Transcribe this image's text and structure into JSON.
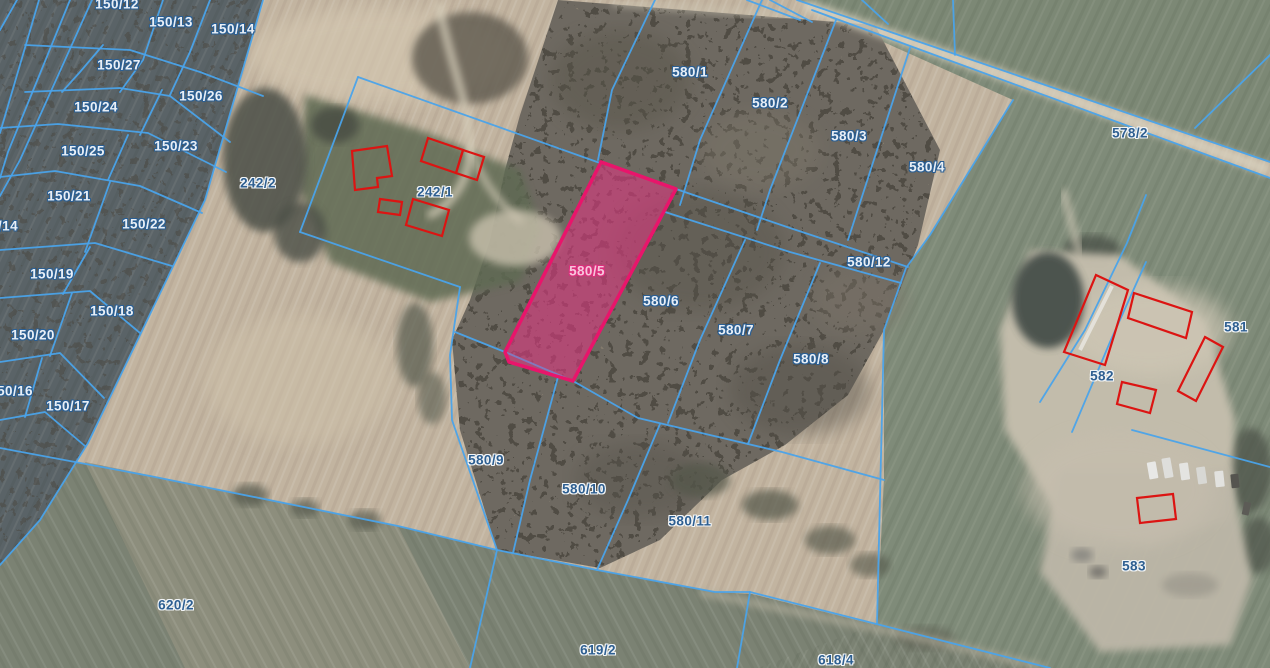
{
  "map": {
    "type": "cadastral-aerial-map",
    "colors": {
      "parcel_line": "#4aa3ea",
      "highlight_stroke": "#e8156b",
      "highlight_fill": "rgba(222,55,128,0.36)",
      "building_stroke": "#dc1412",
      "label_light": "#e9eff6",
      "label_light_outline": "#2b5f93",
      "label_dark": "#2e5f91",
      "label_pink": "#f6c6db",
      "label_pink_outline": "#dd2f7d"
    },
    "highlighted_parcel": {
      "id": "580/5"
    },
    "parcels": [
      {
        "id": "150/12",
        "x": 117,
        "y": 4,
        "style": "light"
      },
      {
        "id": "150/13",
        "x": 171,
        "y": 22,
        "style": "light"
      },
      {
        "id": "150/14",
        "x": 233,
        "y": 29,
        "style": "light"
      },
      {
        "id": "150/27",
        "x": 119,
        "y": 65,
        "style": "light"
      },
      {
        "id": "150/26",
        "x": 201,
        "y": 96,
        "style": "light"
      },
      {
        "id": "150/24",
        "x": 96,
        "y": 107,
        "style": "light"
      },
      {
        "id": "150/25",
        "x": 83,
        "y": 151,
        "style": "light"
      },
      {
        "id": "150/23",
        "x": 176,
        "y": 146,
        "style": "light"
      },
      {
        "id": "150/21",
        "x": 69,
        "y": 196,
        "style": "light"
      },
      {
        "id": "150/22",
        "x": 144,
        "y": 224,
        "style": "light"
      },
      {
        "id": "/14",
        "x": 8,
        "y": 226,
        "style": "light"
      },
      {
        "id": "150/19",
        "x": 52,
        "y": 274,
        "style": "light"
      },
      {
        "id": "150/18",
        "x": 112,
        "y": 311,
        "style": "light"
      },
      {
        "id": "150/20",
        "x": 33,
        "y": 335,
        "style": "light"
      },
      {
        "id": "50/16",
        "x": 15,
        "y": 391,
        "style": "light"
      },
      {
        "id": "150/17",
        "x": 68,
        "y": 406,
        "style": "light"
      },
      {
        "id": "242/2",
        "x": 258,
        "y": 183,
        "style": "dark"
      },
      {
        "id": "242/1",
        "x": 435,
        "y": 192,
        "style": "dark"
      },
      {
        "id": "580/1",
        "x": 690,
        "y": 72,
        "style": "light"
      },
      {
        "id": "580/2",
        "x": 770,
        "y": 103,
        "style": "light"
      },
      {
        "id": "580/3",
        "x": 849,
        "y": 136,
        "style": "light"
      },
      {
        "id": "580/4",
        "x": 927,
        "y": 167,
        "style": "light"
      },
      {
        "id": "578/2",
        "x": 1130,
        "y": 133,
        "style": "dark"
      },
      {
        "id": "580/12",
        "x": 869,
        "y": 262,
        "style": "light"
      },
      {
        "id": "580/5",
        "x": 587,
        "y": 271,
        "style": "pink"
      },
      {
        "id": "580/6",
        "x": 661,
        "y": 301,
        "style": "light"
      },
      {
        "id": "580/7",
        "x": 736,
        "y": 330,
        "style": "light"
      },
      {
        "id": "580/8",
        "x": 811,
        "y": 359,
        "style": "light"
      },
      {
        "id": "581",
        "x": 1236,
        "y": 327,
        "style": "dark"
      },
      {
        "id": "582",
        "x": 1102,
        "y": 376,
        "style": "dark"
      },
      {
        "id": "583",
        "x": 1134,
        "y": 566,
        "style": "dark"
      },
      {
        "id": "580/9",
        "x": 486,
        "y": 460,
        "style": "dark"
      },
      {
        "id": "580/10",
        "x": 584,
        "y": 489,
        "style": "dark"
      },
      {
        "id": "580/11",
        "x": 690,
        "y": 521,
        "style": "dark"
      },
      {
        "id": "620/2",
        "x": 176,
        "y": 605,
        "style": "dark"
      },
      {
        "id": "619/2",
        "x": 598,
        "y": 650,
        "style": "dark"
      },
      {
        "id": "618/4",
        "x": 836,
        "y": 660,
        "style": "dark"
      }
    ]
  }
}
